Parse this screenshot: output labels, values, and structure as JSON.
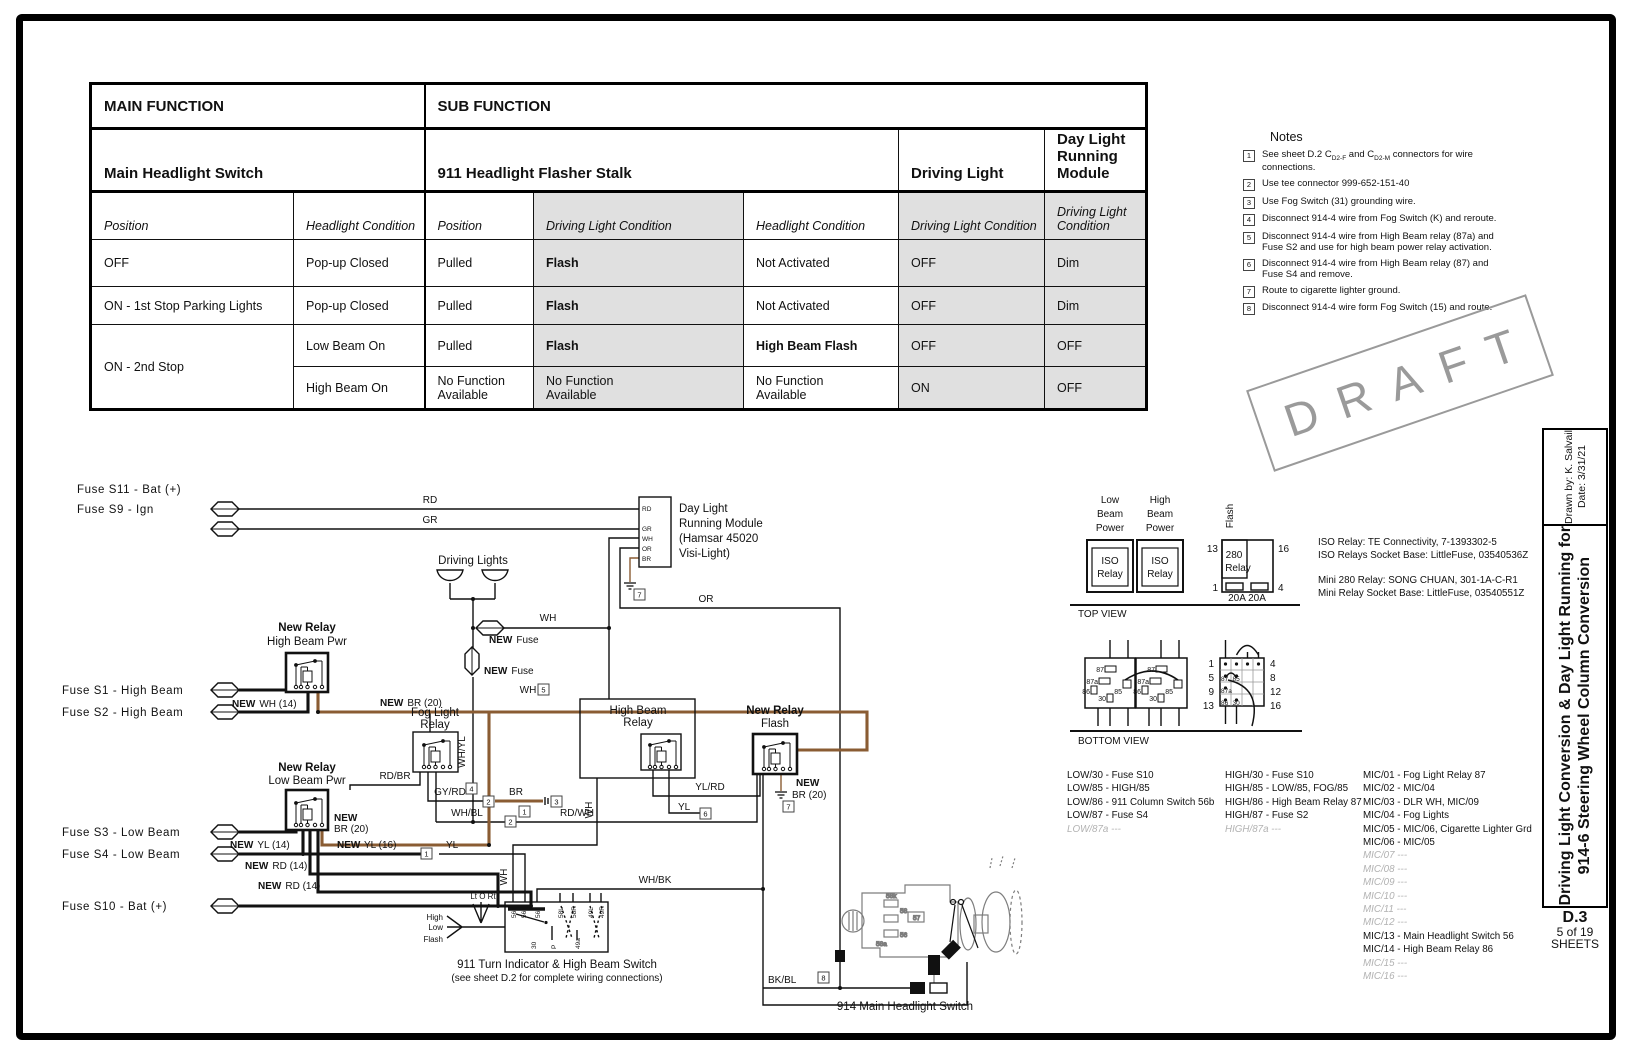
{
  "page": {
    "watermark": "DRAFT",
    "drawn_by": "Drawn by:  K. Salvail",
    "date": "Date:  3/31/21",
    "title_line1": "Driving Light Conversion & Day Light Running for",
    "title_line2": "914-6 Steering Wheel Column Conversion",
    "sheet_code": "D.3",
    "sheet_number": "5 of 19",
    "sheets_label": "SHEETS"
  },
  "function_table": {
    "head1": [
      "MAIN FUNCTION",
      "SUB FUNCTION"
    ],
    "head2": [
      "Main Headlight Switch",
      "911 Headlight Flasher Stalk",
      "Driving Light",
      "Day Light Running Module"
    ],
    "sub_headers": [
      "Position",
      "Headlight Condition",
      "Position",
      "Driving Light Condition",
      "Headlight Condition",
      "Driving Light Condition",
      "Driving Light Condition"
    ],
    "rows": [
      [
        "OFF",
        "Pop-up Closed",
        "Pulled",
        "Flash",
        "Not Activated",
        "OFF",
        "Dim"
      ],
      [
        "ON - 1st Stop Parking Lights",
        "Pop-up Closed",
        "Pulled",
        "Flash",
        "Not Activated",
        "OFF",
        "Dim"
      ],
      [
        "ON - 2nd Stop",
        "Low Beam On",
        "Pulled",
        "Flash",
        "High Beam Flash",
        "OFF",
        "OFF"
      ],
      [
        "High Beam On",
        "No Function Available",
        "No Function Available",
        "No Function Available",
        "ON",
        "OFF"
      ]
    ]
  },
  "notes": {
    "title": "Notes",
    "items": [
      {
        "num": "1",
        "parts": [
          "See sheet D.2 C",
          "D2-F",
          " and C",
          "D2-M",
          " connectors for wire connections."
        ]
      },
      {
        "num": "2",
        "text": "Use tee connector 999-652-151-40"
      },
      {
        "num": "3",
        "text": "Use Fog Switch (31) grounding wire."
      },
      {
        "num": "4",
        "text": "Disconnect 914-4 wire from Fog Switch (K) and reroute."
      },
      {
        "num": "5",
        "text": "Disconnect 914-4 wire from High Beam relay (87a) and Fuse S2 and use for high beam power relay activation."
      },
      {
        "num": "6",
        "text": "Disconnect 914-4 wire from High Beam relay (87) and Fuse S4 and remove."
      },
      {
        "num": "7",
        "text": "Route to cigarette lighter ground."
      },
      {
        "num": "8",
        "text": "Disconnect 914-4 wire form Fog Switch (15) and route."
      }
    ]
  },
  "diagram": {
    "fuses": {
      "s11": "Fuse S11 - Bat (+)",
      "s9": "Fuse S9 - Ign",
      "s1": "Fuse S1 - High Beam",
      "s2": "Fuse S2 - High Beam",
      "s3": "Fuse S3 - Low Beam",
      "s4": "Fuse S4 - Low Beam",
      "s10": "Fuse S10 - Bat (+)"
    },
    "labels": {
      "rd": "RD",
      "gr": "GR",
      "wh": "WH",
      "or": "OR",
      "br": "BR",
      "yl": "YL",
      "wh_yl": "WH/YL",
      "rd_br": "RD/BR",
      "gy_rd": "GY/RD",
      "wh_bl": "WH/BL",
      "rd_wh": "RD/WH",
      "yl_rd": "YL/RD",
      "wh_bk": "WH/BK",
      "bk_bl": "BK/BL",
      "new": "NEW",
      "fuse": "Fuse",
      "wh14": "WH (14)",
      "br20": "BR (20)",
      "yl14": "YL (14)",
      "rd14": "RD (14)",
      "yl16": "YL (16)",
      "new_relay": "New Relay",
      "hb_pwr": "High Beam Pwr",
      "lb_pwr": "Low Beam Pwr",
      "fog1": "Fog Light",
      "relay": "Relay",
      "hb": "High Beam",
      "flash": "Flash",
      "driving_lights": "Driving Lights",
      "dlr1": "Day Light",
      "dlr2": "Running Module",
      "dlr3": "(Hamsar 45020",
      "dlr4": "Visi-Light)",
      "sw911_1": "911 Turn Indicator & High Beam Switch",
      "sw911_2": "(see sheet D.2 for complete wiring connections)",
      "sw914": "914 Main Headlight Switch",
      "lt_o_rt": "Lt O Rt",
      "high": "High",
      "low": "Low",
      "beam": "Beam",
      "power": "Power",
      "iso": "ISO",
      "r280": "280",
      "a20": "20A 20A",
      "top_view": "TOP VIEW",
      "bottom_view": "BOTTOM VIEW"
    },
    "nums": {
      "1": "1",
      "2": "2",
      "3": "3",
      "4": "4",
      "5": "5",
      "6": "6",
      "7": "7",
      "8": "8",
      "9": "9",
      "12": "12",
      "13": "13",
      "16": "16"
    },
    "pins911_top": [
      "56a",
      "56b",
      "56",
      "58L",
      "58R",
      "49L",
      "49R"
    ],
    "pins911_bottom": [
      "30",
      "P",
      "49a"
    ],
    "relay_pins": [
      "87",
      "87a",
      "86",
      "85",
      "30"
    ],
    "sketch_pins": [
      "58k",
      "58",
      "57",
      "56",
      "58a"
    ],
    "parts": [
      "ISO Relay: TE Connectivity, 7-1393302-5",
      "ISO Relays Socket Base: LittleFuse, 03540536Z",
      "Mini 280 Relay: SONG CHUAN, 301-1A-C-R1",
      "Mini Relay Socket Base: LittleFuse, 03540551Z"
    ],
    "lists": {
      "low": [
        {
          "t": "LOW/30 - Fuse S10",
          "dim": false
        },
        {
          "t": "LOW/85 - HIGH/85",
          "dim": false
        },
        {
          "t": "LOW/86 - 911 Column Switch 56b",
          "dim": false
        },
        {
          "t": "LOW/87 - Fuse S4",
          "dim": false
        },
        {
          "t": "LOW/87a ---",
          "dim": true
        }
      ],
      "high": [
        {
          "t": "HIGH/30 - Fuse S10",
          "dim": false
        },
        {
          "t": "HIGH/85 - LOW/85, FOG/85",
          "dim": false
        },
        {
          "t": "HIGH/86 - High Beam Relay 87",
          "dim": false
        },
        {
          "t": "HIGH/87 - Fuse S2",
          "dim": false
        },
        {
          "t": "HIGH/87a ---",
          "dim": true
        }
      ],
      "mic": [
        {
          "t": "MIC/01 - Fog Light Relay 87",
          "dim": false
        },
        {
          "t": "MIC/02 - MIC/04",
          "dim": false
        },
        {
          "t": "MIC/03 - DLR WH, MIC/09",
          "dim": false
        },
        {
          "t": "MIC/04 - Fog Lights",
          "dim": false
        },
        {
          "t": "MIC/05 - MIC/06, Cigarette Lighter Grd",
          "dim": false
        },
        {
          "t": "MIC/06 - MIC/05",
          "dim": false
        },
        {
          "t": "MIC/07 ---",
          "dim": true
        },
        {
          "t": "MIC/08 ---",
          "dim": true
        },
        {
          "t": "MIC/09 ---",
          "dim": true
        },
        {
          "t": "MIC/10 ---",
          "dim": true
        },
        {
          "t": "MIC/11 ---",
          "dim": true
        },
        {
          "t": "MIC/12 ---",
          "dim": true
        },
        {
          "t": "MIC/13 - Main Headlight Switch 56",
          "dim": false
        },
        {
          "t": "MIC/14 - High Beam Relay 86",
          "dim": false
        },
        {
          "t": "MIC/15 ---",
          "dim": true
        },
        {
          "t": "MIC/16 ---",
          "dim": true
        }
      ]
    }
  }
}
